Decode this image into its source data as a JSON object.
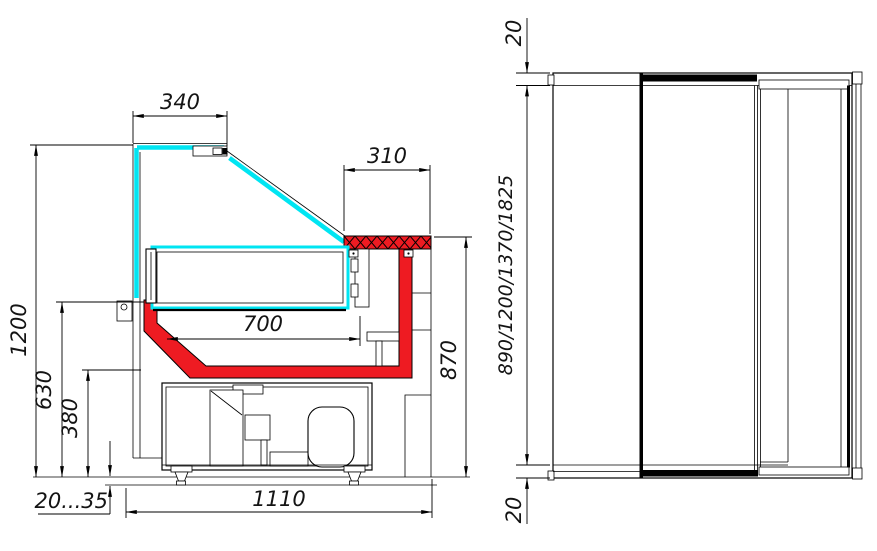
{
  "colors": {
    "glass_cyan": "#00e5f2",
    "liner_red": "#ee1b22",
    "line": "#000000",
    "bg": "#ffffff"
  },
  "side": {
    "d340": "340",
    "d310": "310",
    "d1200": "1200",
    "d700": "700",
    "d870": "870",
    "d630": "630",
    "d380": "380",
    "d2035": "20...35",
    "d1110": "1110"
  },
  "rear": {
    "d20top": "20",
    "dheights": "890/1200/1370/1825",
    "d20bot": "20"
  }
}
